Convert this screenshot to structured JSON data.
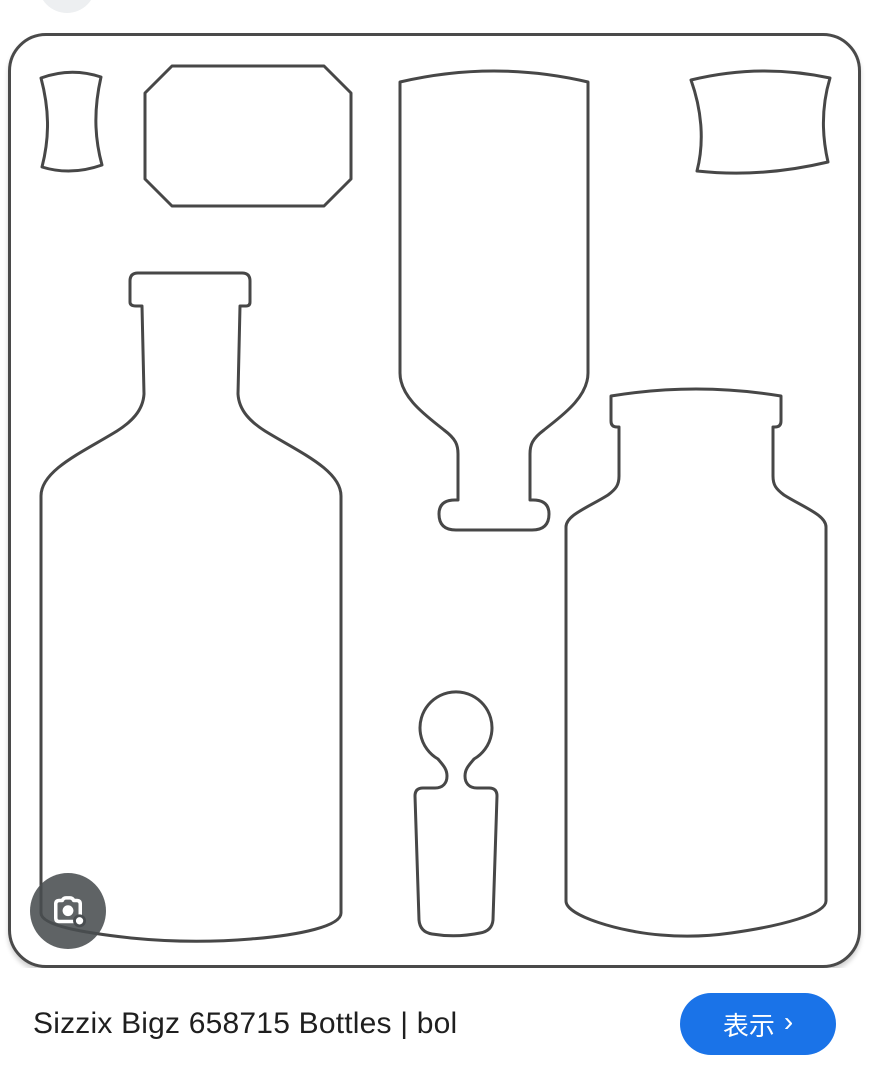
{
  "image_card": {
    "shape_names": [
      "small cork die",
      "octagonal label die",
      "inverted bottle die",
      "wide cork die",
      "large round-shoulder bottle die",
      "ball-top stopper die",
      "square apothecary jar die"
    ]
  },
  "lens": {
    "icon": "google-lens-camera-icon"
  },
  "footer": {
    "title": "Sizzix Bigz 658715 Bottles | bol",
    "visit_label": "表示",
    "visit_chevron": "›"
  },
  "colors": {
    "accent_blue": "#1a73e8",
    "line_art": "#474747",
    "card_border": "#4a4a4a",
    "lens_button_bg": "rgba(73,77,80,0.88)",
    "title_text": "#1f1f1f"
  }
}
